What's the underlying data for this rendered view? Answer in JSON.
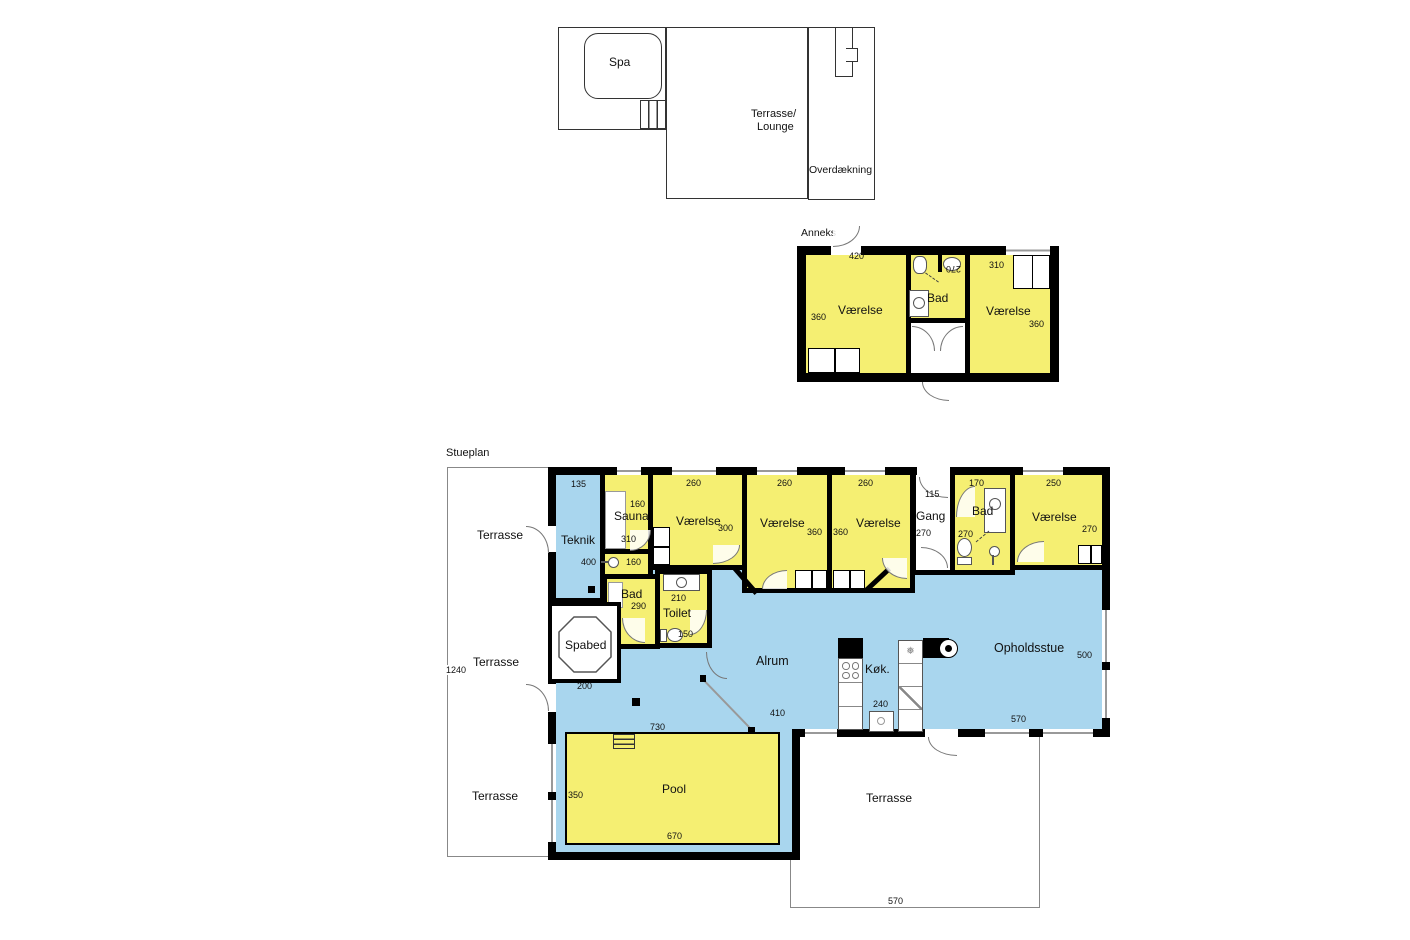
{
  "title": "Stueplan",
  "colors": {
    "room_yellow": "#F5EF72",
    "wet_blue": "#A9D6EE",
    "wall": "#000000"
  },
  "upper_terrace": {
    "spa": "Spa",
    "lounge_line1": "Terrasse/",
    "lounge_line2": "Lounge",
    "cover": "Overdækning"
  },
  "anneks": {
    "label": "Anneks",
    "left_room": {
      "name": "Værelse",
      "width": "420",
      "depth": "360"
    },
    "bath": {
      "name": "Bad",
      "depth": "270"
    },
    "right_room": {
      "name": "Værelse",
      "width": "310",
      "depth": "360"
    }
  },
  "main": {
    "teknik": {
      "name": "Teknik",
      "width": "135",
      "depth": "400"
    },
    "sauna": {
      "name": "Sauna",
      "width": "160",
      "depth": "310"
    },
    "shower": {
      "width": "160"
    },
    "bath1": {
      "name": "Bad",
      "depth": "290"
    },
    "toilet": {
      "name": "Toilet",
      "width": "210",
      "depth": "150"
    },
    "bedroom1": {
      "name": "Værelse",
      "width": "260",
      "depth": "300"
    },
    "bedroom2": {
      "name": "Værelse",
      "width": "260",
      "depth": "360"
    },
    "bedroom3": {
      "name": "Værelse",
      "width": "260",
      "depth": "360"
    },
    "hall": {
      "name": "Gang",
      "width": "115",
      "depth": "270"
    },
    "bath2": {
      "name": "Bad",
      "width": "170",
      "depth": "270"
    },
    "bedroom4": {
      "name": "Værelse",
      "width": "250",
      "depth": "270"
    },
    "family_room": {
      "name": "Alrum",
      "width": "410",
      "width_west": "730"
    },
    "kitchen": {
      "name": "Køk.",
      "width": "240"
    },
    "living_room": {
      "name": "Opholdsstue",
      "depth": "500",
      "width": "570"
    },
    "spa_bed": {
      "name": "Spabed",
      "width": "200"
    },
    "pool": {
      "name": "Pool",
      "depth": "350",
      "width_bottom": "670"
    }
  },
  "terraces": {
    "west": {
      "label1": "Terrasse",
      "label2": "Terrasse",
      "label3": "Terrasse",
      "length": "1240"
    },
    "south": {
      "label": "Terrasse",
      "width": "570"
    }
  }
}
